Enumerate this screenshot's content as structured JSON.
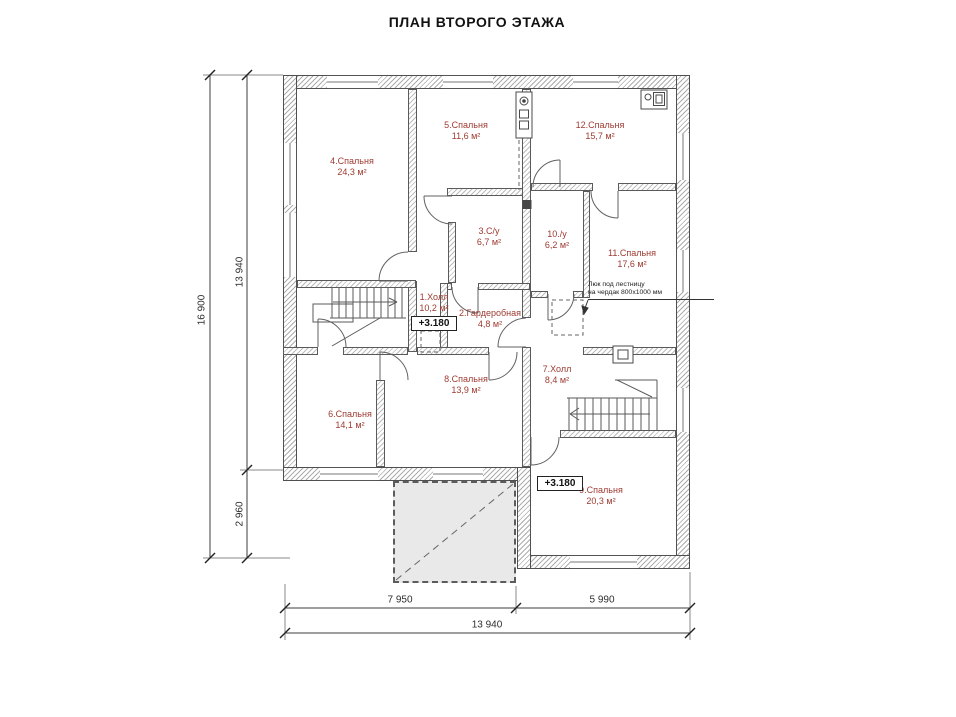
{
  "title": "ПЛАН ВТОРОГО ЭТАЖА",
  "colors": {
    "room_label": "#9e3a31",
    "wall_edge": "#4f4f4f",
    "hatch": "#adadad",
    "terrace_fill": "#e9e9e9",
    "dimension_text": "#2e2e2e"
  },
  "rooms": [
    {
      "name": "4.Спальня",
      "area": "24,3 м²"
    },
    {
      "name": "5.Спальня",
      "area": "11,6 м²"
    },
    {
      "name": "12.Спальня",
      "area": "15,7 м²"
    },
    {
      "name": "3.С/у",
      "area": "6,7 м²"
    },
    {
      "name": "10./у",
      "area": "6,2 м²"
    },
    {
      "name": "11.Спальня",
      "area": "17,6 м²"
    },
    {
      "name": "1.Холл",
      "area": "10,2 м²"
    },
    {
      "name": "2.Гардеробная",
      "area": "4,8 м²"
    },
    {
      "name": "8.Спальня",
      "area": "13,9 м²"
    },
    {
      "name": "6.Спальня",
      "area": "14,1 м²"
    },
    {
      "name": "7.Холл",
      "area": "8,4 м²"
    },
    {
      "name": "9.Спальня",
      "area": "20,3 м²"
    }
  ],
  "levels": [
    {
      "value": "+3.180"
    },
    {
      "value": "+3.180"
    }
  ],
  "annotations": {
    "attic_note_line1": "Люк под лестницу",
    "attic_note_line2": "на чердак 800х1000 мм"
  },
  "dimensions": {
    "left_total": "16 900",
    "left_upper": "13 940",
    "left_lower": "2 960",
    "bottom_left": "7 950",
    "bottom_right": "5 990",
    "bottom_total": "13 940"
  }
}
